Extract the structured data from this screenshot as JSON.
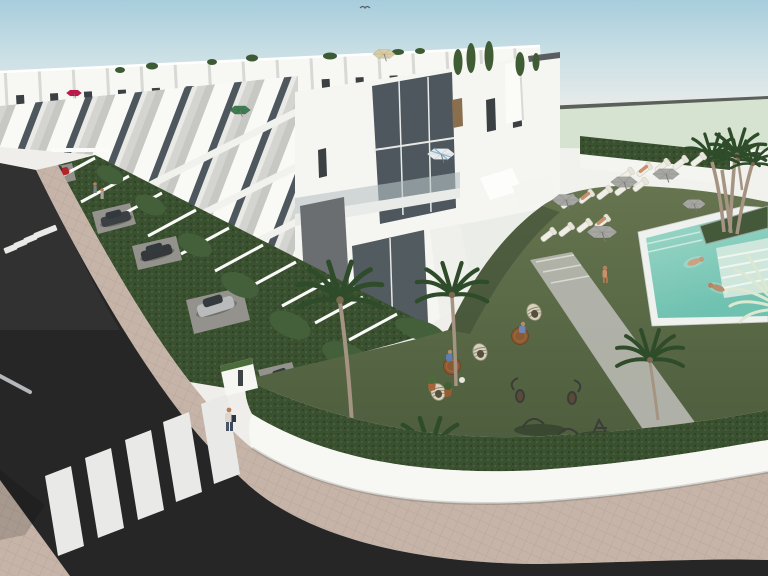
{
  "scene": {
    "type": "architectural_render",
    "description": "Aerial 3D architectural rendering of a modern white townhouse development: two long rows of flat-roofed houses with rooftop terraces, plants and colored parasols; front gardens with hedges, white dividing walls and parked cars along a dark asphalt street with two zebra crossings and beige paver sidewalks; a landscaped communal area with artificial lawn, wicker furniture, sun loungers under grey parasols, palm trees and a turquoise swimming pool with two swimmers.",
    "sky": {
      "condition": "clear pale blue fading to white haze"
    },
    "buildings": {
      "rows": 2,
      "style": "modern white multi-storey townhouses",
      "features": [
        "rooftop terraces with planters",
        "glass balustrade balconies",
        "dark recessed windows",
        "grey accent panels",
        "wood louvre shutter"
      ],
      "rooftop_parasols": [
        "red",
        "green",
        "tan",
        "white-blue"
      ]
    },
    "street": {
      "surface": "dark asphalt",
      "crosswalks": [
        {
          "location": "upper-left",
          "stripes": 5
        },
        {
          "location": "lower-left",
          "stripes": 5
        }
      ],
      "sidewalk": "beige pavers",
      "street_pole": 1
    },
    "front_gardens": {
      "hedges": true,
      "white_dividing_walls": true,
      "parked_cars": [
        "red",
        "dark-grey",
        "dark-grey",
        "silver",
        "beige"
      ]
    },
    "amenity_area": {
      "lawn": "olive green turf",
      "pool": {
        "water": "turquoise",
        "swimmers": 2,
        "tanning_ledge": true,
        "raised_planter_with_palms": true
      },
      "sun_loungers": 14,
      "grey_parasols": 5,
      "wicker_tables": 2,
      "cocoon_chairs": 3,
      "decor_urns": 2,
      "palm_trees": 7
    },
    "people": {
      "pedestrians_on_sidewalk": 3,
      "person_with_bag_at_crossing": 1,
      "sunbathers_on_loungers": 3,
      "seated_at_tables": 2,
      "walking_on_lawn": 1,
      "swimmers": 2
    }
  },
  "palette": {
    "haze": "#efeeea",
    "skyTop": "#a7cddc",
    "skyMid": "#c9dfe5",
    "road": "#262626",
    "roadLight": "#343434",
    "sidewalk": "#c6b4a8",
    "stripeWhite": "#e9e9e7",
    "lawn": "#5c6c49",
    "lawnDark": "#4c5c3c",
    "hedge": "#3a512f",
    "hedgeDark": "#2c3f24",
    "distantLawn": "#d6e3d0",
    "wallWhite": "#f7f7f4",
    "faceWhite": "#f9f9f6",
    "faceShade": "#c7c7c3",
    "glassDark": "#4d575d",
    "panelGray": "#6a6e71",
    "slabLight": "#efefea",
    "poolWater": "#83cdbc",
    "poolDeep": "#6fc1b0",
    "poolLedge": "#cfe6dc",
    "coping": "#eff1ee",
    "palmGreen": "#2e4b2a",
    "trunk": "#a59482",
    "umbGray": "#a7a7a3",
    "umbRed": "#c2184b",
    "umbTan": "#d9cda6",
    "umbGreen": "#3f7d52",
    "lounger": "#f0efe7",
    "skin": "#c9906c",
    "wicker": "#8a5a33",
    "potClay": "#a4653a",
    "carRed": "#b22428",
    "carDark": "#3c4043",
    "carSilver": "#b8babc",
    "carGold": "#b09a55"
  }
}
